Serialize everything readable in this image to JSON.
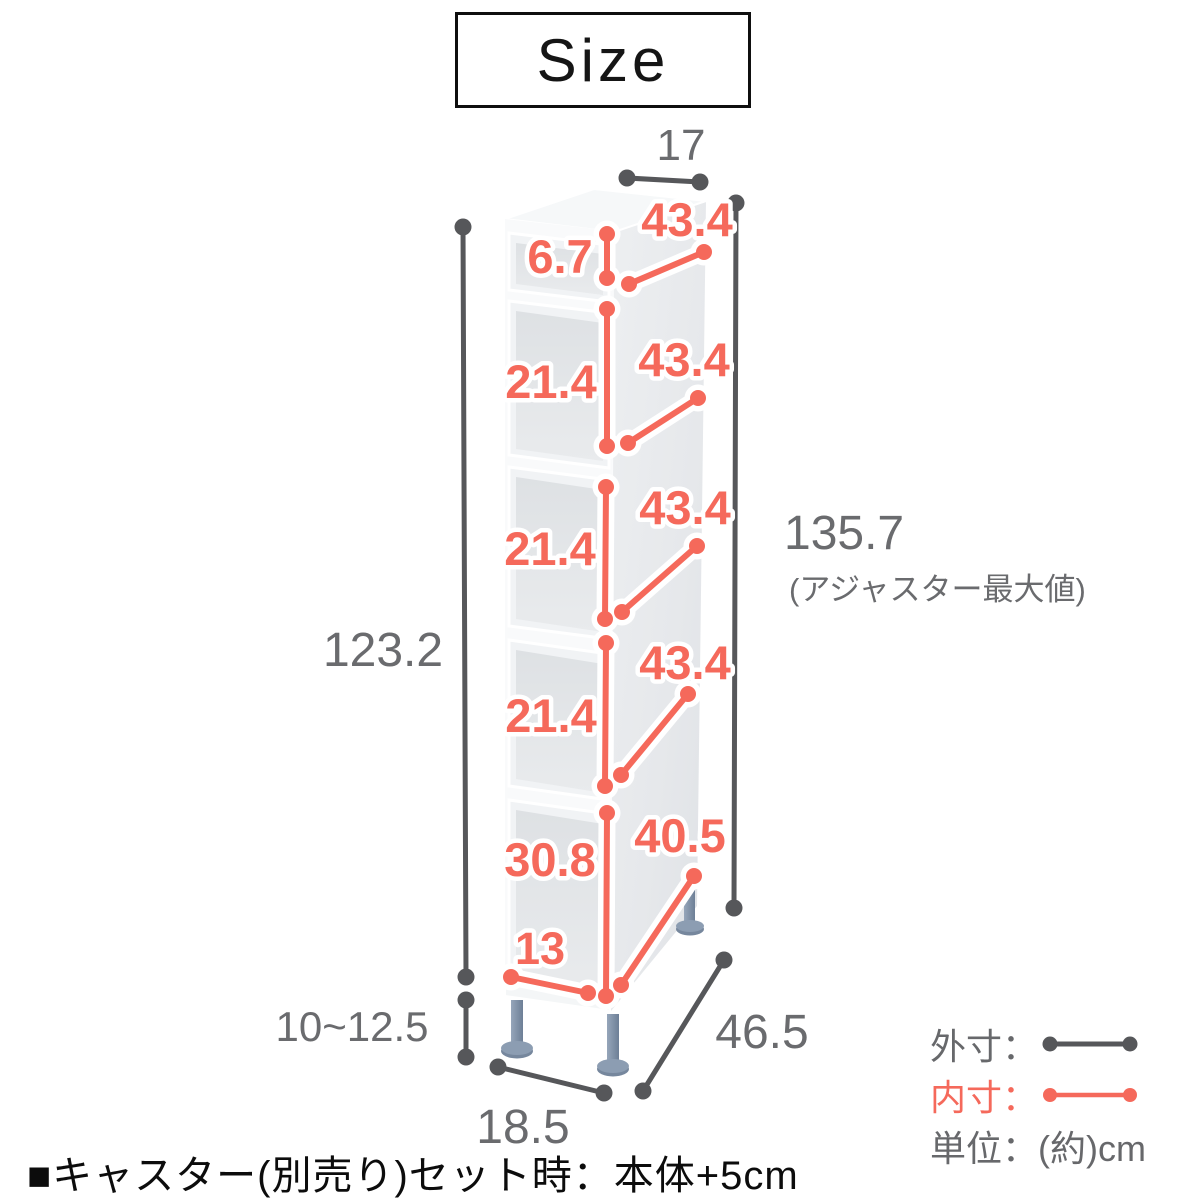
{
  "title": "Size",
  "colors": {
    "inner_dim": "#F5695B",
    "outer_dim_line": "#56575A",
    "outer_dim_text": "#6A6B6E",
    "leg_blue": "#7E90A6"
  },
  "dims": {
    "top_width": "17",
    "body_height": "123.2",
    "adjuster_range": "10~12.5",
    "max_height": "135.7",
    "max_height_note": "(アジャスター最大値)",
    "depth": "46.5",
    "bottom_width": "18.5",
    "drawer1_height": "6.7",
    "drawer1_depth": "43.4",
    "drawer2_height": "21.4",
    "drawer2_depth": "43.4",
    "drawer3_height": "21.4",
    "drawer3_depth": "43.4",
    "drawer4_height": "21.4",
    "drawer4_depth": "43.4",
    "drawer5_height": "30.8",
    "drawer5_width": "13",
    "drawer5_depth": "40.5"
  },
  "legend": {
    "outer_label": "外寸：",
    "inner_label": "内寸：",
    "unit_label": "単位：",
    "unit_value": "(約)cm"
  },
  "footnote": "■キャスター(別売り)セット時：本体+5cm"
}
